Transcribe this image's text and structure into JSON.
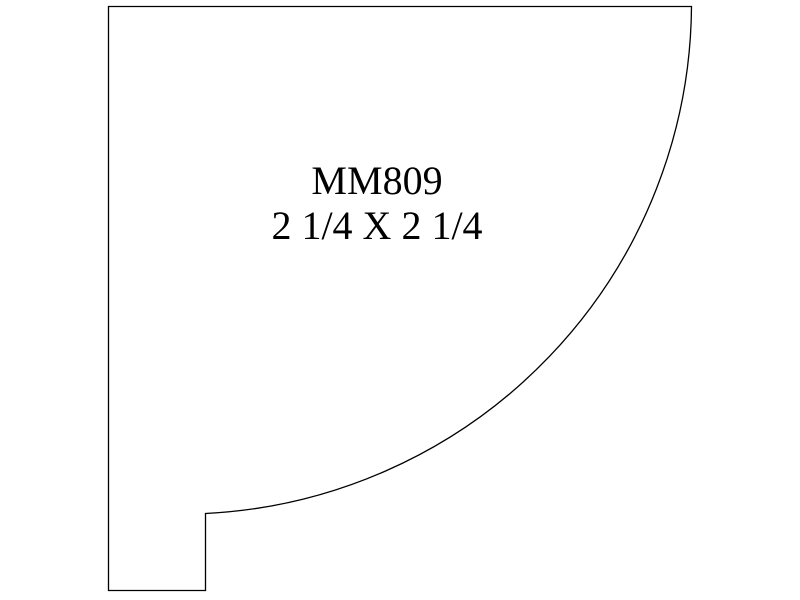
{
  "drawing": {
    "title": "Molding profile drawing",
    "profile_code": "MM809",
    "size_label": "2 1/4 X 2 1/4",
    "outline_color": "#000000",
    "background_color": "#ffffff",
    "geometry": {
      "top_left": [
        108,
        6
      ],
      "top_right": [
        692,
        6
      ],
      "arc_radius": 511,
      "arc_end_step_top": [
        205,
        513
      ],
      "step_bottom": [
        205,
        590
      ],
      "bottom_left": [
        108,
        590
      ]
    }
  }
}
